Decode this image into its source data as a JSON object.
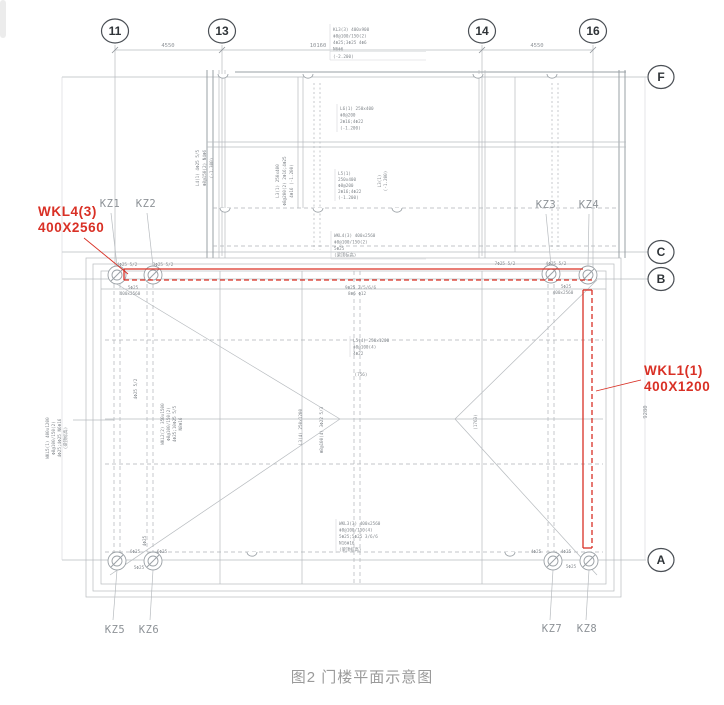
{
  "figure": {
    "caption": "图2 门楼平面示意图"
  },
  "colors": {
    "highlight_red": "#d93025",
    "line_gray": "#b7bbbf",
    "bubble_gray": "#4a4f55",
    "text_gray": "#8d9297"
  },
  "grid": {
    "top_bubbles": [
      {
        "label": "11"
      },
      {
        "label": "13"
      },
      {
        "label": "14"
      },
      {
        "label": "16"
      }
    ],
    "side_bubbles": [
      {
        "label": "F"
      },
      {
        "label": "C"
      },
      {
        "label": "B"
      },
      {
        "label": "A"
      }
    ]
  },
  "dimensions": {
    "top": [
      "4550",
      "10160",
      "4550"
    ],
    "right_vertical": "9280"
  },
  "columns": {
    "top": [
      "KZ1",
      "KZ2",
      "KZ3",
      "KZ4"
    ],
    "bottom": [
      "KZ5",
      "KZ6",
      "KZ7",
      "KZ8"
    ]
  },
  "beam_callouts": {
    "wkl4": {
      "name": "WKL4(3)",
      "size": "400X2560"
    },
    "wkl1": {
      "name": "WKL1(1)",
      "size": "400X1200"
    }
  },
  "notes": {
    "top_beam": [
      "KL3(3) 400x900",
      "Φ8@100/150(2)",
      "4Φ25;3Φ25 4Φ6",
      "N6Φ6",
      "(-2.200)"
    ],
    "porch_a": [
      "L6(1) 250x400",
      "Φ8@200",
      "2Φ16;4Φ22",
      "(-1.200)"
    ],
    "porch_b": [
      "L5(1)",
      "250x400",
      "Φ8@200",
      "2Φ16;4Φ22",
      "(-1.200)"
    ],
    "porch_vert_a": [
      "L4(1) 4Φ25 5/5",
      "Φ8@150(2) N4Φ6",
      "(-1.300)"
    ],
    "porch_vert_b": [
      "L3(1) 250x400",
      "Φ8@200(2) 2Φ16;4Φ25",
      "4Φ16 (-1.200)"
    ],
    "porch_vert_c": [
      "L3(1)",
      "(-1.200)"
    ],
    "wkl4_spec": [
      "WKL4(3) 400x2560",
      "Φ8@100/150(2)",
      "5Φ25",
      "(梁顶标高)"
    ],
    "beam_top": [
      "4Φ25 5/2",
      "3Φ25 5/2",
      "7Φ25 5/2",
      "4Φ25 5/2"
    ],
    "kz1_rebar": [
      "5Φ25",
      "400x2560"
    ],
    "kz4_rebar": [
      "5Φ25",
      "400x2560"
    ],
    "beam_mid": [
      "9Φ25 2/5/6/6",
      "8Φ6 Φ12"
    ],
    "slab_center": [
      "L5(4) 250x1200",
      "Φ8@100(4)",
      "4Φ22"
    ],
    "left_vert": [
      "WKL5(1) 400x1200",
      "Φ8@100/150(2)",
      "4Φ25;4Φ25 N6Φ16",
      "(梁顶标高)"
    ],
    "mid_vert": [
      "WKL2(2) 350x1500",
      "Φ8@100/150(2)",
      "4Φ25;10Φ25 5/5",
      "N8Φ16"
    ],
    "small_vert": "4Φ25 5/2",
    "center_vert_a": "L3(4) 250x1200",
    "center_vert_b": "Φ8@100(4) 3Φ22 5/3",
    "dim_a": "(756)",
    "dim_b": "(1763)",
    "wkl3_spec": [
      "WKL3(3) 400x2560",
      "Φ8@100/150(4)",
      "5Φ25;5Φ25 3/6/6",
      "N16Φ16",
      "(梁顶标高)"
    ],
    "bottom_left": [
      "6Φ25",
      "6Φ25",
      "5Φ25"
    ],
    "bottom_right": [
      "4Φ25",
      "4Φ25",
      "5Φ25"
    ],
    "bottom_vert": "4Φ25"
  }
}
